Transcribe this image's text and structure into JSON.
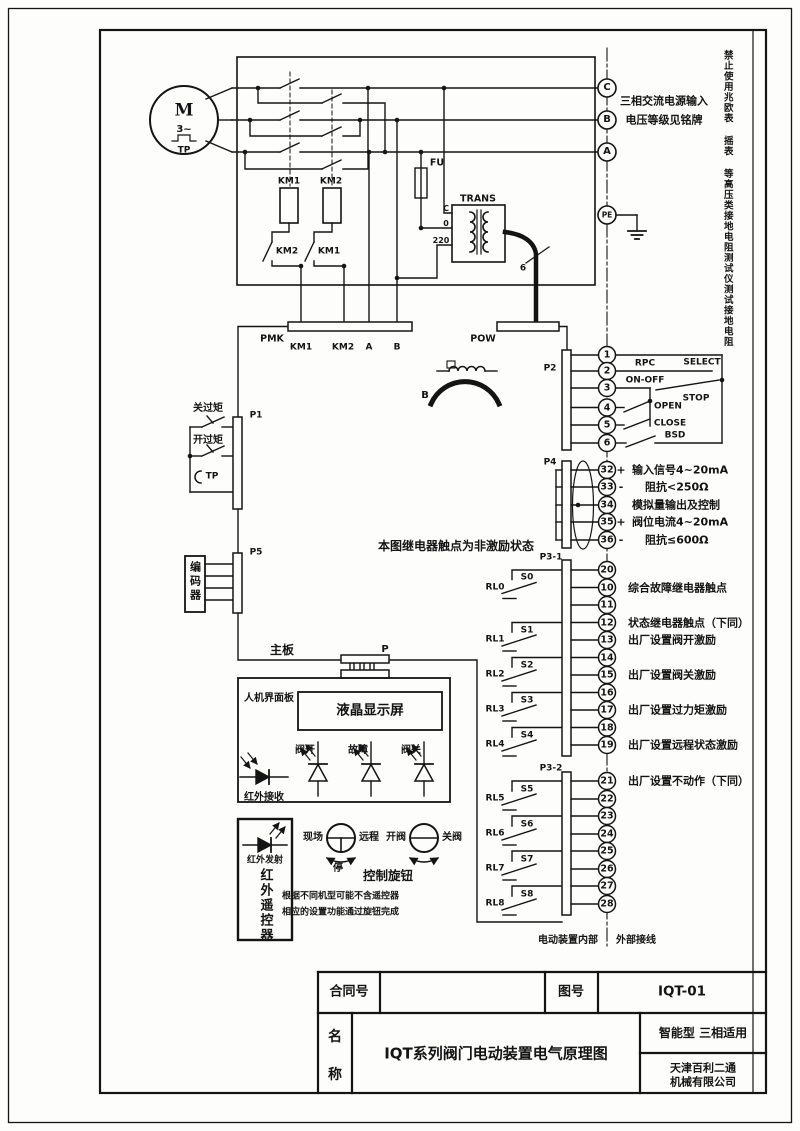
{
  "power": {
    "motor": {
      "m": "M",
      "phase": "3~",
      "tp": "TP"
    },
    "coil1": "KM1",
    "coil2": "KM2",
    "interlock1": "KM2",
    "interlock2": "KM1",
    "fuse": "FU",
    "transformer": {
      "name": "TRANS",
      "pin_top": "C",
      "pin_mid": "0",
      "pin_bottom": "220"
    },
    "cable_core_count": "6",
    "choke_label": "B"
  },
  "supply": {
    "terminals": [
      "C",
      "B",
      "A"
    ],
    "pe": "PE",
    "note_line1": "三相交流电源输入",
    "note_line2": "电压等级见铭牌",
    "warning": "禁止使用兆欧表 摇表 等高压类接地电阻测试仪测试接地电阻"
  },
  "bars": {
    "pmk": "PMK",
    "pmk_pins": [
      "KM1",
      "KM2",
      "A",
      "B"
    ],
    "pow": "POW",
    "p1": "P1",
    "p5": "P5",
    "p2": "P2",
    "p4": "P4",
    "p31": "P3-1",
    "p32": "P3-2",
    "p": "P"
  },
  "left": {
    "close_torque": "关过矩",
    "open_torque": "开过矩",
    "tp": "TP",
    "encoder": "编码器",
    "mainboard": "主板"
  },
  "note": "本图继电器触点为非激励状态",
  "p2": {
    "terminals": [
      "1",
      "2",
      "3",
      "4",
      "5",
      "6"
    ],
    "select": "SELECT",
    "rpc": "RPC",
    "onoff": "ON-OFF",
    "stop": "STOP",
    "open": "OPEN",
    "close": "CLOSE",
    "bsd": "BSD"
  },
  "p4": {
    "rows": [
      {
        "no": "32",
        "sign": "+",
        "label": "输入信号4~20mA"
      },
      {
        "no": "33",
        "sign": "-",
        "label": "阻抗<250Ω"
      },
      {
        "no": "34",
        "sign": "",
        "label": "模拟量输出及控制"
      },
      {
        "no": "35",
        "sign": "+",
        "label": "阀位电流4~20mA"
      },
      {
        "no": "36",
        "sign": "-",
        "label": "阻抗≤600Ω"
      }
    ]
  },
  "p31": {
    "terminals": [
      "20",
      "10",
      "11",
      "12",
      "13",
      "14",
      "15",
      "16",
      "17",
      "18",
      "19"
    ],
    "relays": [
      {
        "name": "RL0",
        "s": "S0"
      },
      {
        "name": "RL1",
        "s": "S1"
      },
      {
        "name": "RL2",
        "s": "S2"
      },
      {
        "name": "RL3",
        "s": "S3"
      },
      {
        "name": "RL4",
        "s": "S4"
      }
    ],
    "annotations": [
      "综合故障继电器触点",
      "状态继电器触点（下同）",
      "出厂设置阀开激励",
      "出厂设置阀关激励",
      "出厂设置过力矩激励",
      "出厂设置远程状态激励"
    ]
  },
  "p32": {
    "terminals": [
      "21",
      "22",
      "23",
      "24",
      "25",
      "26",
      "27",
      "28"
    ],
    "relays": [
      {
        "name": "RL5",
        "s": "S5"
      },
      {
        "name": "RL6",
        "s": "S6"
      },
      {
        "name": "RL7",
        "s": "S7"
      },
      {
        "name": "RL8",
        "s": "S8"
      }
    ],
    "annotation": "出厂设置不动作（下同）"
  },
  "boundary": {
    "internal": "电动装置内部",
    "external": "外部接线"
  },
  "hmi": {
    "panel": "人机界面板",
    "lcd": "液晶显示屏",
    "led_open": "阀开",
    "led_fault": "故障",
    "led_close": "阀关",
    "ir_receive": "红外接收"
  },
  "remote": {
    "ir_transmit": "红外发射",
    "controller": "红外遥控器",
    "local": "现场",
    "remote": "远程",
    "stop": "停",
    "open_valve": "开阀",
    "close_valve": "关阀",
    "knob": "控制旋钮",
    "note1": "根据不同机型可能不含遥控器",
    "note2": "相应的设置功能通过旋钮完成"
  },
  "title_block": {
    "contract_label": "合同号",
    "contract_value": "",
    "drawing_label": "图号",
    "drawing_no": "IQT-01",
    "name_label_top": "名",
    "name_label_bottom": "称",
    "name": "IQT系列阀门电动装置电气原理图",
    "type_note": "智能型  三相适用",
    "company1": "天津百利二通",
    "company2": "机械有限公司"
  }
}
